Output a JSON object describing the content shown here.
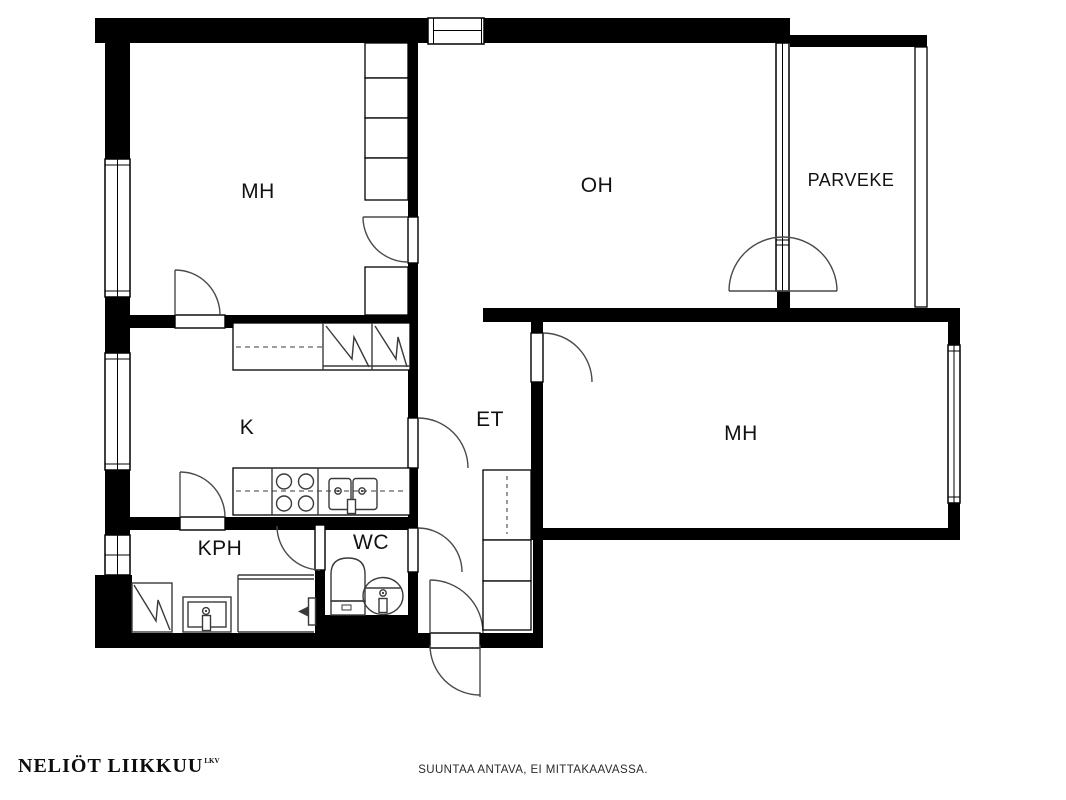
{
  "plan": {
    "rooms": {
      "bedroom1": {
        "label": "MH"
      },
      "living_room": {
        "label": "OH"
      },
      "balcony": {
        "label": "PARVEKE"
      },
      "kitchen": {
        "label": "K"
      },
      "entry_hall": {
        "label": "ET"
      },
      "bedroom2": {
        "label": "MH"
      },
      "bathroom": {
        "label": "KPH"
      },
      "toilet": {
        "label": "WC"
      }
    },
    "colors": {
      "wall": "#000000",
      "background": "#ffffff",
      "fixture_line": "#3a3a3a"
    }
  },
  "footer": {
    "brand": "NELIÖT LIIKKUU",
    "brand_suffix": "LKV",
    "disclaimer": "SUUNTAA ANTAVA, EI MITTAKAAVASSA."
  }
}
